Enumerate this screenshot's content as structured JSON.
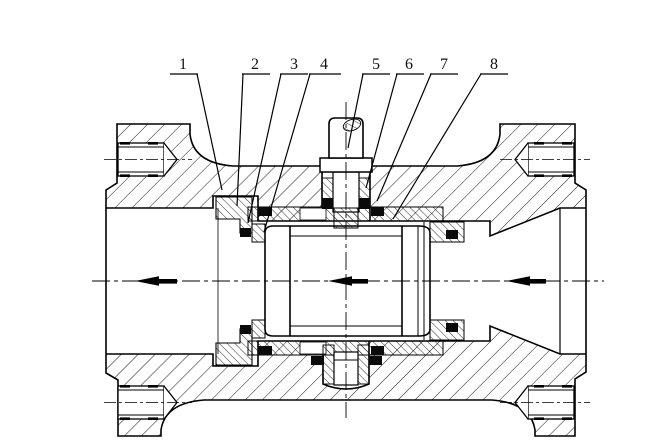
{
  "title": "Ball valve sectional engineering drawing",
  "callouts": [
    {
      "label": "1"
    },
    {
      "label": "2"
    },
    {
      "label": "3"
    },
    {
      "label": "4"
    },
    {
      "label": "5"
    },
    {
      "label": "6"
    },
    {
      "label": "7"
    },
    {
      "label": "8"
    }
  ],
  "flow_arrows": {
    "direction": "left",
    "count": 3
  },
  "colors": {
    "ink": "#000000",
    "paper": "#ffffff"
  }
}
